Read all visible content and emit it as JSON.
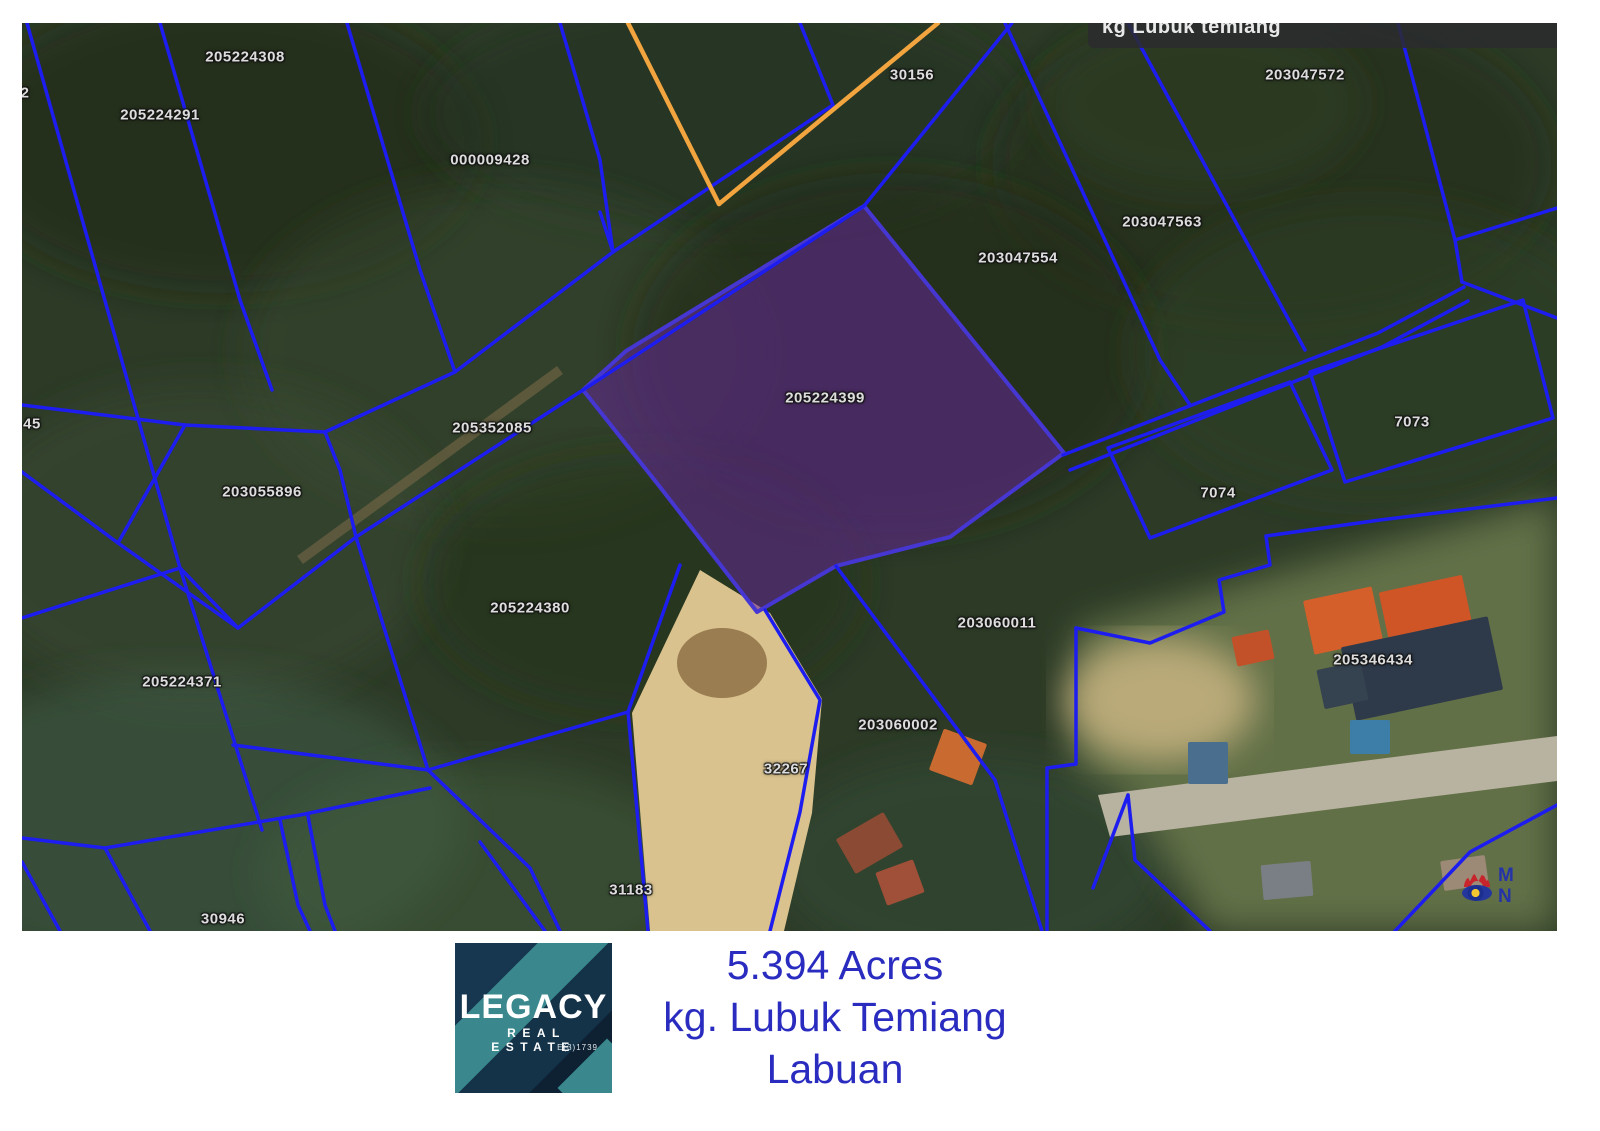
{
  "map": {
    "region_label": "kg Lubuk temiang",
    "colors": {
      "boundary_blue": "#1d1df0",
      "boundary_orange": "#f2a43f",
      "highlight_fill": "rgba(101,38,152,0.55)",
      "highlight_stroke": "#4636d2",
      "ground_base": "#2c3a26",
      "sand": "#d9c28e",
      "road": "#b8b2a0"
    },
    "labels": [
      {
        "text": "2",
        "x": 3,
        "y": 70
      },
      {
        "text": "205224308",
        "x": 223,
        "y": 34
      },
      {
        "text": "205224291",
        "x": 138,
        "y": 92
      },
      {
        "text": "000009428",
        "x": 468,
        "y": 137
      },
      {
        "text": "30156",
        "x": 890,
        "y": 52
      },
      {
        "text": "203047572",
        "x": 1283,
        "y": 52
      },
      {
        "text": "203047563",
        "x": 1140,
        "y": 199
      },
      {
        "text": "203047554",
        "x": 996,
        "y": 235
      },
      {
        "text": "205224399",
        "x": 803,
        "y": 375
      },
      {
        "text": "205352085",
        "x": 470,
        "y": 405
      },
      {
        "text": "45",
        "x": 10,
        "y": 401
      },
      {
        "text": "203055896",
        "x": 240,
        "y": 469
      },
      {
        "text": "7073",
        "x": 1390,
        "y": 399
      },
      {
        "text": "7074",
        "x": 1196,
        "y": 470
      },
      {
        "text": "205224380",
        "x": 508,
        "y": 585
      },
      {
        "text": "203060011",
        "x": 975,
        "y": 600
      },
      {
        "text": "205346434",
        "x": 1351,
        "y": 637
      },
      {
        "text": "205224371",
        "x": 160,
        "y": 659
      },
      {
        "text": "203060002",
        "x": 876,
        "y": 702
      },
      {
        "text": "32267",
        "x": 764,
        "y": 746
      },
      {
        "text": "31183",
        "x": 609,
        "y": 867
      },
      {
        "text": "30946",
        "x": 201,
        "y": 896
      }
    ],
    "highlight_parcel": {
      "id": "205224399",
      "points": [
        [
          842,
          183
        ],
        [
          1042,
          430
        ],
        [
          928,
          514
        ],
        [
          814,
          543
        ],
        [
          735,
          589
        ],
        [
          638,
          464
        ],
        [
          561,
          367
        ],
        [
          604,
          328
        ]
      ]
    },
    "lines": {
      "blue": [
        [
          [
            5,
            0
          ],
          [
            158,
            545
          ],
          [
            240,
            807
          ]
        ],
        [
          [
            138,
            0
          ],
          [
            218,
            277
          ],
          [
            250,
            367
          ]
        ],
        [
          [
            325,
            0
          ],
          [
            398,
            247
          ],
          [
            433,
            349
          ]
        ],
        [
          [
            538,
            0
          ],
          [
            578,
            137
          ],
          [
            591,
            229
          ]
        ],
        [
          [
            216,
            605
          ],
          [
            334,
            514
          ],
          [
            561,
            367
          ],
          [
            842,
            183
          ],
          [
            990,
            0
          ]
        ],
        [
          [
            778,
            0
          ],
          [
            811,
            82
          ],
          [
            591,
            229
          ]
        ],
        [
          [
            591,
            229
          ],
          [
            578,
            189
          ]
        ],
        [
          [
            303,
            409
          ],
          [
            433,
            349
          ],
          [
            591,
            229
          ]
        ],
        [
          [
            0,
            382
          ],
          [
            163,
            402
          ],
          [
            303,
            409
          ]
        ],
        [
          [
            303,
            409
          ],
          [
            318,
            447
          ],
          [
            334,
            514
          ]
        ],
        [
          [
            0,
            449
          ],
          [
            96,
            520
          ],
          [
            163,
            402
          ]
        ],
        [
          [
            96,
            520
          ],
          [
            216,
            605
          ]
        ],
        [
          [
            216,
            605
          ],
          [
            158,
            545
          ]
        ],
        [
          [
            0,
            595
          ],
          [
            158,
            545
          ]
        ],
        [
          [
            334,
            514
          ],
          [
            406,
            747
          ]
        ],
        [
          [
            211,
            722
          ],
          [
            406,
            747
          ]
        ],
        [
          [
            406,
            747
          ],
          [
            606,
            689
          ]
        ],
        [
          [
            406,
            747
          ],
          [
            508,
            845
          ],
          [
            538,
            908
          ]
        ],
        [
          [
            606,
            689
          ],
          [
            658,
            542
          ]
        ],
        [
          [
            606,
            689
          ],
          [
            626,
            908
          ]
        ],
        [
          [
            743,
            587
          ],
          [
            798,
            677
          ],
          [
            778,
            789
          ],
          [
            748,
            908
          ]
        ],
        [
          [
            814,
            543
          ],
          [
            973,
            757
          ],
          [
            1020,
            908
          ]
        ],
        [
          [
            0,
            815
          ],
          [
            83,
            825
          ],
          [
            278,
            792
          ],
          [
            408,
            765
          ]
        ],
        [
          [
            258,
            797
          ],
          [
            276,
            882
          ],
          [
            288,
            908
          ]
        ],
        [
          [
            286,
            793
          ],
          [
            303,
            882
          ],
          [
            313,
            908
          ]
        ],
        [
          [
            83,
            825
          ],
          [
            128,
            908
          ]
        ],
        [
          [
            0,
            839
          ],
          [
            38,
            908
          ]
        ],
        [
          [
            458,
            819
          ],
          [
            523,
            908
          ]
        ],
        [
          [
            983,
            0
          ],
          [
            1138,
            337
          ],
          [
            1168,
            382
          ]
        ],
        [
          [
            1106,
            0
          ],
          [
            1283,
            327
          ]
        ],
        [
          [
            1376,
            0
          ],
          [
            1433,
            217
          ],
          [
            1440,
            259
          ]
        ],
        [
          [
            1433,
            217
          ],
          [
            1535,
            185
          ]
        ],
        [
          [
            1440,
            259
          ],
          [
            1535,
            295
          ]
        ],
        [
          [
            1041,
            432
          ],
          [
            1356,
            310
          ],
          [
            1442,
            264
          ]
        ],
        [
          [
            1048,
            447
          ],
          [
            1360,
            324
          ],
          [
            1446,
            278
          ]
        ],
        [
          [
            1288,
            349
          ],
          [
            1501,
            277
          ],
          [
            1531,
            395
          ],
          [
            1323,
            459
          ],
          [
            1288,
            349
          ]
        ],
        [
          [
            1086,
            425
          ],
          [
            1268,
            359
          ],
          [
            1310,
            447
          ],
          [
            1128,
            515
          ],
          [
            1086,
            425
          ]
        ],
        [
          [
            1025,
            908
          ],
          [
            1025,
            745
          ],
          [
            1054,
            741
          ],
          [
            1054,
            605
          ]
        ],
        [
          [
            1054,
            605
          ],
          [
            1128,
            620
          ],
          [
            1202,
            589
          ],
          [
            1197,
            557
          ],
          [
            1248,
            542
          ],
          [
            1244,
            513
          ],
          [
            1358,
            497
          ],
          [
            1535,
            475
          ]
        ],
        [
          [
            1071,
            865
          ],
          [
            1106,
            772
          ]
        ],
        [
          [
            1106,
            772
          ],
          [
            1113,
            837
          ],
          [
            1188,
            908
          ]
        ],
        [
          [
            1373,
            908
          ],
          [
            1448,
            829
          ],
          [
            1535,
            782
          ]
        ]
      ],
      "orange": [
        [
          [
            606,
            0
          ],
          [
            697,
            181
          ]
        ],
        [
          [
            697,
            181
          ],
          [
            916,
            0
          ]
        ]
      ]
    },
    "terrain": {
      "blobs": [
        {
          "cx": 200,
          "cy": 120,
          "rx": 260,
          "ry": 150,
          "fill": "#1e2a18",
          "op": 0.55
        },
        {
          "cx": 700,
          "cy": 90,
          "rx": 300,
          "ry": 120,
          "fill": "#25331d",
          "op": 0.5
        },
        {
          "cx": 1250,
          "cy": 140,
          "rx": 280,
          "ry": 160,
          "fill": "#202d1a",
          "op": 0.5
        },
        {
          "cx": 480,
          "cy": 330,
          "rx": 260,
          "ry": 170,
          "fill": "#364a2c",
          "op": 0.4
        },
        {
          "cx": 870,
          "cy": 330,
          "rx": 260,
          "ry": 180,
          "fill": "#1b2615",
          "op": 0.55
        },
        {
          "cx": 1350,
          "cy": 330,
          "rx": 240,
          "ry": 150,
          "fill": "#2f4026",
          "op": 0.45
        },
        {
          "cx": 180,
          "cy": 520,
          "rx": 240,
          "ry": 160,
          "fill": "#3c5134",
          "op": 0.4
        },
        {
          "cx": 620,
          "cy": 560,
          "rx": 220,
          "ry": 130,
          "fill": "#24331c",
          "op": 0.5
        },
        {
          "cx": 160,
          "cy": 800,
          "rx": 280,
          "ry": 150,
          "fill": "#41604a",
          "op": 0.5
        },
        {
          "cx": 460,
          "cy": 850,
          "rx": 220,
          "ry": 110,
          "fill": "#3f5c3e",
          "op": 0.5
        },
        {
          "cx": 950,
          "cy": 840,
          "rx": 200,
          "ry": 110,
          "fill": "#35503c",
          "op": 0.45
        },
        {
          "cx": 1180,
          "cy": 80,
          "rx": 160,
          "ry": 90,
          "fill": "#33442a",
          "op": 0.4
        }
      ],
      "clearing_right": [
        [
          1054,
          605
        ],
        [
          1535,
          475
        ],
        [
          1535,
          908
        ],
        [
          1188,
          908
        ],
        [
          1106,
          772
        ],
        [
          1054,
          745
        ]
      ],
      "sand_main": [
        [
          678,
          547
        ],
        [
          748,
          590
        ],
        [
          800,
          676
        ],
        [
          790,
          790
        ],
        [
          762,
          908
        ],
        [
          628,
          908
        ],
        [
          610,
          690
        ]
      ],
      "sand_patch": {
        "cx": 1138,
        "cy": 677,
        "rx": 95,
        "ry": 62,
        "fill": "#c9b481",
        "op": 0.85
      },
      "road": [
        [
          1076,
          772
        ],
        [
          1535,
          713
        ],
        [
          1535,
          758
        ],
        [
          1088,
          814
        ]
      ],
      "track": {
        "points": [
          [
            278,
            537
          ],
          [
            538,
            347
          ]
        ],
        "color": "#7d6b4a",
        "width": 10,
        "op": 0.55
      }
    },
    "buildings": [
      {
        "x": 1286,
        "y": 570,
        "w": 70,
        "h": 55,
        "rot": -12,
        "fill": "#d45f2a"
      },
      {
        "x": 1362,
        "y": 560,
        "w": 85,
        "h": 60,
        "rot": -12,
        "fill": "#cf5526"
      },
      {
        "x": 1212,
        "y": 610,
        "w": 38,
        "h": 30,
        "rot": -12,
        "fill": "#c2512a"
      },
      {
        "x": 1325,
        "y": 608,
        "w": 150,
        "h": 75,
        "rot": -12,
        "fill": "#2e3a4a"
      },
      {
        "x": 1298,
        "y": 642,
        "w": 45,
        "h": 40,
        "rot": -12,
        "fill": "#35424f"
      },
      {
        "x": 1328,
        "y": 697,
        "w": 40,
        "h": 34,
        "rot": 0,
        "fill": "#3d7ea8"
      },
      {
        "x": 913,
        "y": 712,
        "w": 46,
        "h": 44,
        "rot": 20,
        "fill": "#c96a31"
      },
      {
        "x": 820,
        "y": 800,
        "w": 55,
        "h": 40,
        "rot": -30,
        "fill": "#8a4a33"
      },
      {
        "x": 858,
        "y": 842,
        "w": 40,
        "h": 35,
        "rot": -20,
        "fill": "#a05038"
      },
      {
        "x": 1166,
        "y": 719,
        "w": 40,
        "h": 42,
        "rot": 0,
        "fill": "#4a6e8e"
      },
      {
        "x": 1240,
        "y": 840,
        "w": 50,
        "h": 35,
        "rot": -5,
        "fill": "#7a7f85"
      },
      {
        "x": 1420,
        "y": 835,
        "w": 45,
        "h": 30,
        "rot": -8,
        "fill": "#9c8976"
      }
    ],
    "watermark_letters": "M N"
  },
  "caption": {
    "area": "5.394 Acres",
    "village": "kg. Lubuk Temiang",
    "territory": "Labuan"
  },
  "logo": {
    "name": "LEGACY",
    "tagline": "REAL ESTATE",
    "license": "E(3)1739"
  }
}
